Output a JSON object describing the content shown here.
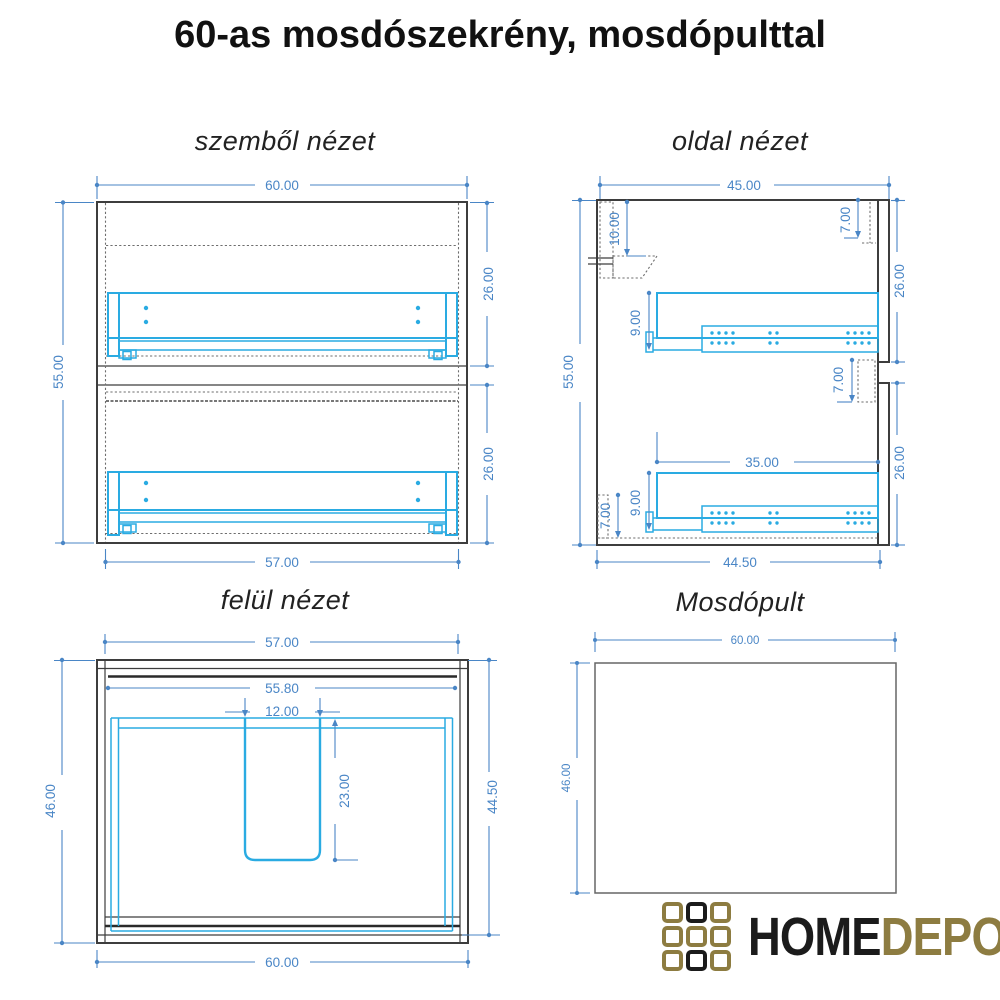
{
  "title": "60-as mosdószekrény, mosdópulttal",
  "colors": {
    "dimension_blue": "#4a86c6",
    "drawer_cyan": "#2aabe2",
    "outline_dark": "#3d3d3d",
    "logo_gold": "#8d7c41",
    "logo_black": "#1b1b1b"
  },
  "views": {
    "front": {
      "title": "szemből nézet",
      "dims": {
        "overall_width": "60.00",
        "overall_height": "55.00",
        "upper_drawer_height": "26.00",
        "lower_drawer_height": "26.00",
        "carcass_width": "57.00"
      }
    },
    "side": {
      "title": "oldal nézet",
      "dims": {
        "overall_depth": "45.00",
        "overall_height": "55.00",
        "bracket_offset": "10.00",
        "back_rail_top": "7.00",
        "upper_section_height": "26.00",
        "upper_rail_offset": "9.00",
        "divider_gap": "7.00",
        "slide_length": "35.00",
        "lower_rail_offset": "9.00",
        "plinth_height": "7.00",
        "lower_section_height": "26.00",
        "carcass_depth": "44.50"
      }
    },
    "top": {
      "title": "felül nézet",
      "dims": {
        "carcass_width": "57.00",
        "inner_width": "55.80",
        "cutout_width": "12.00",
        "cutout_depth": "23.00",
        "overall_depth": "46.00",
        "carcass_depth": "44.50",
        "overall_width": "60.00"
      }
    },
    "counter": {
      "title": "Mosdópult",
      "dims": {
        "width": "60.00",
        "depth": "46.00"
      }
    }
  },
  "logo": {
    "icon": "3x3-squares-grid",
    "text_primary": "HOME",
    "text_secondary": "DEPO"
  }
}
